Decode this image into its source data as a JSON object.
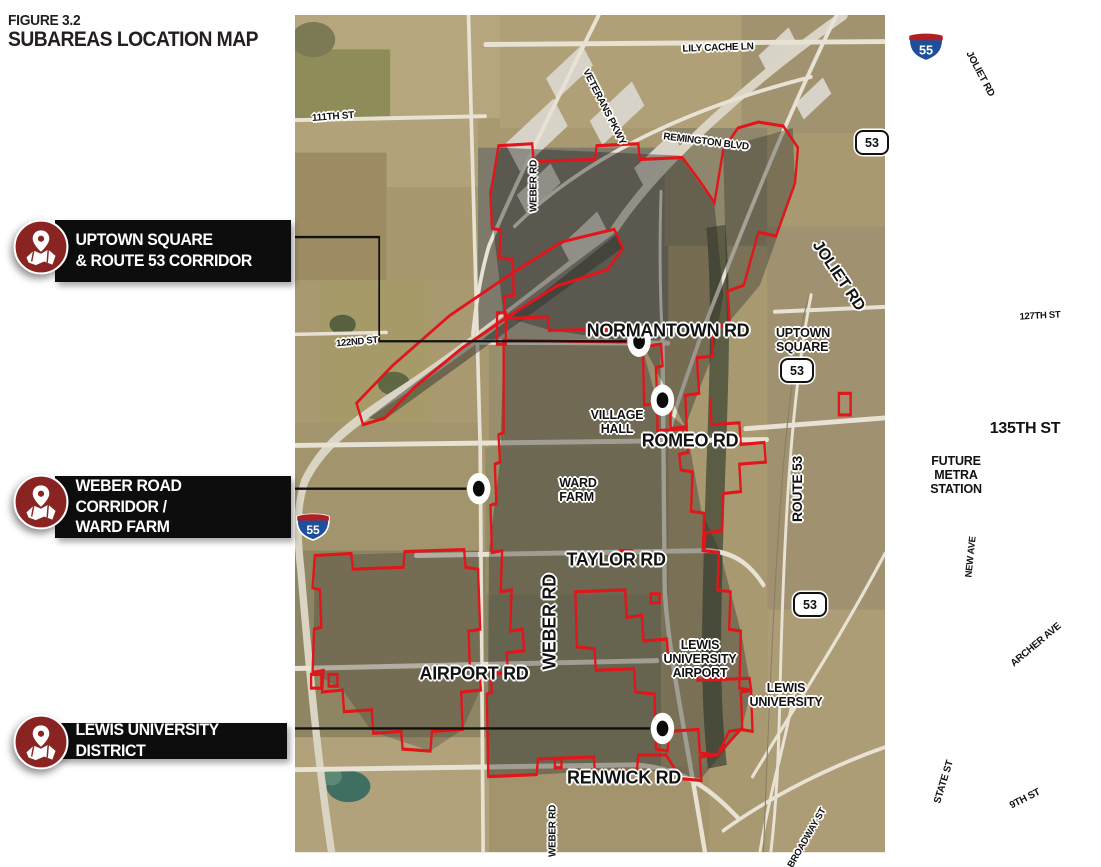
{
  "figure": {
    "label": "FIGURE 3.2",
    "title": "SUBAREAS LOCATION MAP"
  },
  "callouts": [
    {
      "text": "UPTOWN SQUARE\n& ROUTE 53 CORRIDOR"
    },
    {
      "text": "WEBER ROAD CORRIDOR /\nWARD FARM"
    },
    {
      "text": "LEWIS UNIVERSITY DISTRICT"
    }
  ],
  "map": {
    "road_labels": [
      {
        "text": "LILY CACHE LN"
      },
      {
        "text": "VETERANS PKWY"
      },
      {
        "text": "REMINGTON BLVD"
      },
      {
        "text": "111TH ST"
      },
      {
        "text": "WEBER RD"
      },
      {
        "text": "JOLIET RD"
      },
      {
        "text": "JOLIET RD"
      },
      {
        "text": "NORMANTOWN RD"
      },
      {
        "text": "ROMEO RD"
      },
      {
        "text": "122ND ST"
      },
      {
        "text": "127TH ST"
      },
      {
        "text": "135TH ST"
      },
      {
        "text": "ROUTE 53"
      },
      {
        "text": "TAYLOR RD"
      },
      {
        "text": "WEBER RD"
      },
      {
        "text": "AIRPORT RD"
      },
      {
        "text": "RENWICK RD"
      },
      {
        "text": "NEW AVE"
      },
      {
        "text": "ARCHER AVE"
      },
      {
        "text": "STATE ST"
      },
      {
        "text": "9TH ST"
      },
      {
        "text": "BROADWAY ST"
      },
      {
        "text": "WEBER RD"
      }
    ],
    "poi_labels": [
      {
        "text": "UPTOWN\nSQUARE"
      },
      {
        "text": "VILLAGE\nHALL"
      },
      {
        "text": "WARD\nFARM"
      },
      {
        "text": "FUTURE\nMETRA\nSTATION"
      },
      {
        "text": "LEWIS\nUNIVERSITY\nAIRPORT"
      },
      {
        "text": "LEWIS\nUNIVERSITY"
      }
    ],
    "shields": {
      "interstate_55": "55",
      "route_53": "53"
    },
    "colors": {
      "boundary_red": "#e2151b",
      "callout_bg": "#0d0d0d",
      "icon_red": "#8a2422"
    }
  }
}
